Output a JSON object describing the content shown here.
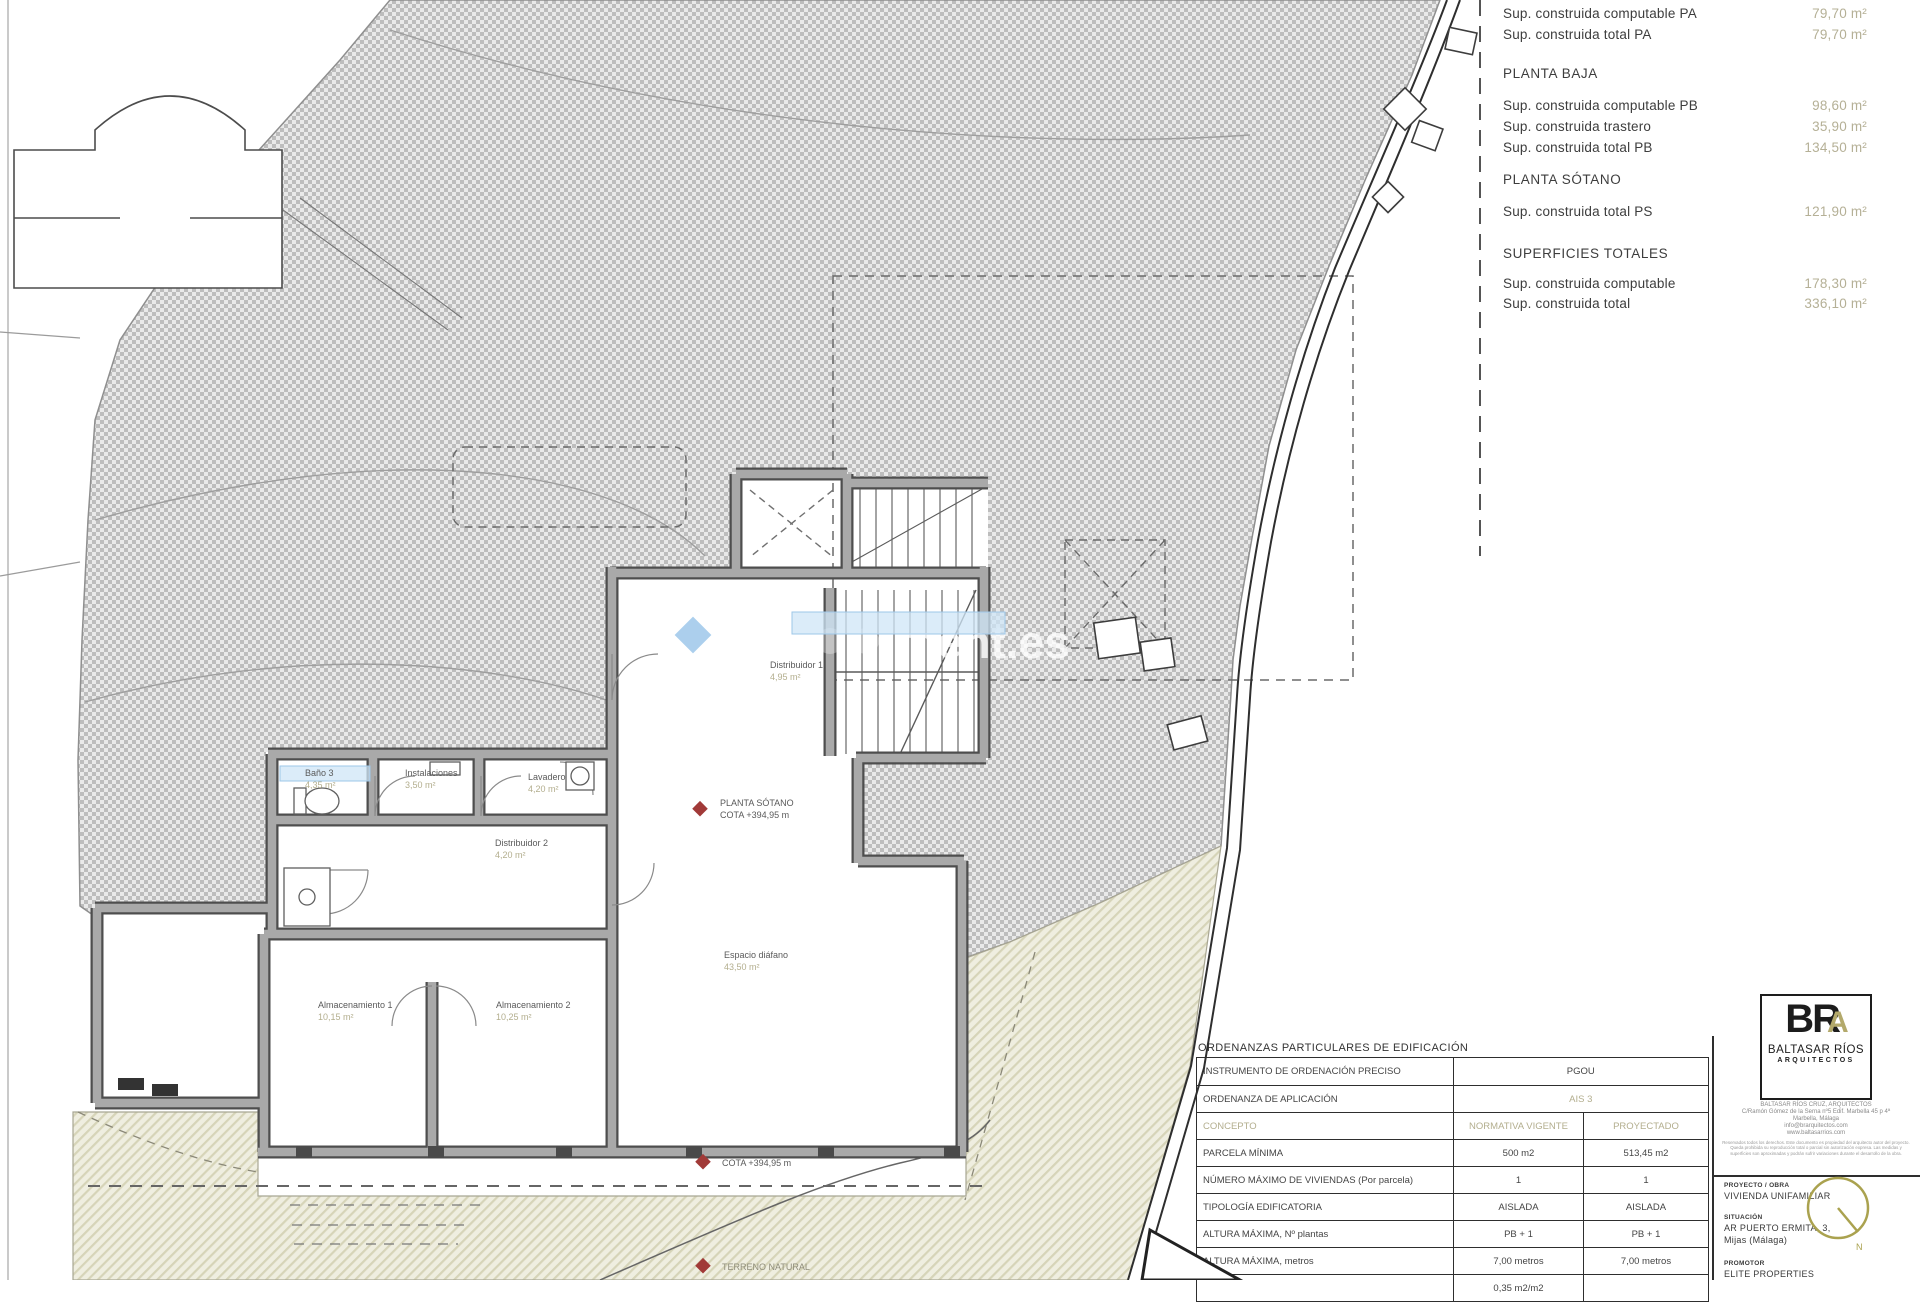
{
  "summary_panel": {
    "top_rows": [
      {
        "label": "Sup. construida computable PA",
        "value": "79,70 m²"
      },
      {
        "label": "Sup. construida total PA",
        "value": "79,70 m²"
      }
    ],
    "planta_baja": {
      "title": "PLANTA BAJA",
      "rows": [
        {
          "label": "Sup. construida computable PB",
          "value": "98,60 m²"
        },
        {
          "label": "Sup. construida trastero",
          "value": "35,90 m²"
        },
        {
          "label": "Sup. construida total PB",
          "value": "134,50 m²"
        }
      ]
    },
    "planta_sotano": {
      "title": "PLANTA SÓTANO",
      "rows": [
        {
          "label": "Sup. construida total PS",
          "value": "121,90 m²"
        }
      ]
    },
    "totales": {
      "title": "SUPERFICIES TOTALES",
      "rows": [
        {
          "label": "Sup. construida computable",
          "value": "178,30 m²"
        },
        {
          "label": "Sup. construida total",
          "value": "336,10 m²"
        }
      ]
    }
  },
  "ordinance_table": {
    "title": "ORDENANZAS PARTICULARES DE EDIFICACIÓN",
    "row1": {
      "label": "INSTRUMENTO DE ORDENACIÓN PRECISO",
      "value": "PGOU"
    },
    "row2": {
      "label": "ORDENANZA DE APLICACIÓN",
      "value": "AIS 3"
    },
    "header": {
      "label": "CONCEPTO",
      "col1": "NORMATIVA VIGENTE",
      "col2": "PROYECTADO"
    },
    "rows": [
      {
        "label": "PARCELA MÍNIMA",
        "col1": "500 m2",
        "col2": "513,45 m2"
      },
      {
        "label": "NÚMERO MÁXIMO DE VIVIENDAS (Por parcela)",
        "col1": "1",
        "col2": "1"
      },
      {
        "label": "TIPOLOGÍA EDIFICATORIA",
        "col1": "AISLADA",
        "col2": "AISLADA"
      },
      {
        "label": "ALTURA MÁXIMA, Nº plantas",
        "col1": "PB + 1",
        "col2": "PB + 1"
      },
      {
        "label": "ALTURA MÁXIMA, metros",
        "col1": "7,00 metros",
        "col2": "7,00 metros"
      },
      {
        "label": "",
        "col1": "0,35 m2/m2",
        "col2": ""
      }
    ]
  },
  "title_block": {
    "logo_br": "BR",
    "logo_a": "A",
    "firm": "BALTASAR RÍOS",
    "firm_sub": "ARQUITECTOS",
    "address": "BALTASAR RÍOS CRUZ, ARQUITECTOS\nC/Ramón Gómez de la Serna nº5 Edif. Marbella 45 p 4ª\nMarbella, Málaga\ninfo@brarquitectos.com\nwww.baltasarrios.com",
    "legal": "Reservados todos los derechos. Este documento es propiedad del arquitecto autor del proyecto. Queda prohibida su reproducción total o parcial sin autorización expresa. Las medidas y superficies son aproximadas y podrán sufrir variaciones durante el desarrollo de la obra.",
    "project_label": "PROYECTO / OBRA",
    "project": "VIVIENDA UNIFAMILIAR",
    "location_label": "SITUACIÓN",
    "location1": "AR PUERTO ERMITA, 3,",
    "location2": "Mijas (Málaga)",
    "developer_label": "PROMOTOR",
    "developer": "ELITE PROPERTIES",
    "north_label": "N"
  },
  "plan_labels": {
    "bano3": {
      "name": "Baño 3",
      "area": "4,35 m²"
    },
    "instalaciones": {
      "name": "Instalaciones",
      "area": "3,50 m²"
    },
    "lavadero": {
      "name": "Lavadero",
      "area": "4,20 m²"
    },
    "distribuidor1": {
      "name": "Distribuidor 1",
      "area": "4,95 m²"
    },
    "distribuidor2": {
      "name": "Distribuidor 2",
      "area": "4,20 m²"
    },
    "almacenamiento1": {
      "name": "Almacenamiento 1",
      "area": "10,15 m²"
    },
    "almacenamiento2": {
      "name": "Almacenamiento 2",
      "area": "10,25 m²"
    },
    "espacio": {
      "name": "Espacio diáfano",
      "area": "43,50 m²"
    },
    "sotano_line1": "PLANTA SÓTANO",
    "sotano_line2": "COTA +394,95 m",
    "cota": "COTA +394,95 m",
    "terreno": "TERRENO NATURAL"
  },
  "watermark": {
    "text": "ment.es"
  },
  "colors": {
    "value_tan": "#b5b096",
    "marker_red": "#a13a38",
    "highlight_blue": "#cfe6f7"
  }
}
